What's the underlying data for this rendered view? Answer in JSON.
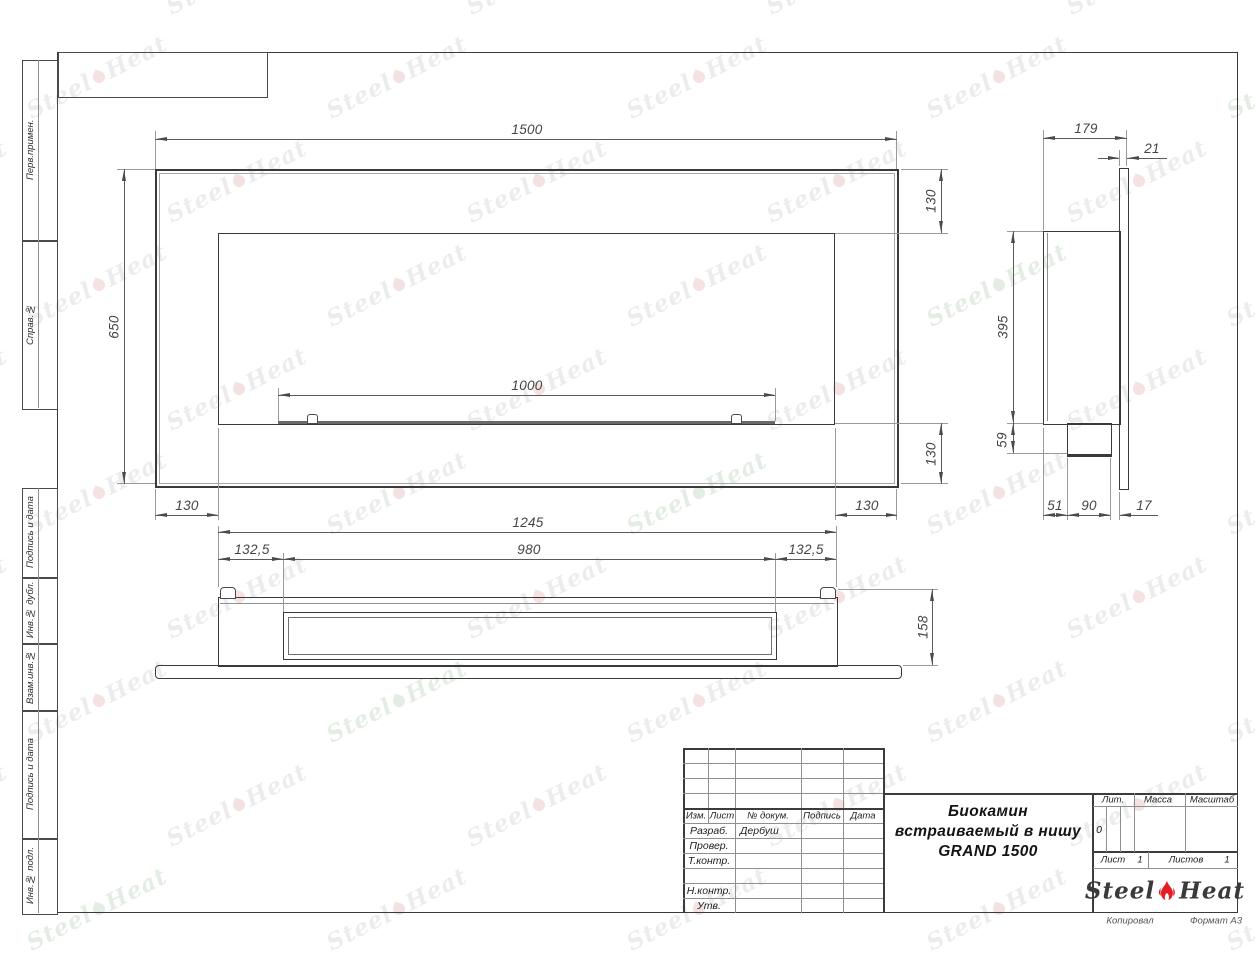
{
  "colors": {
    "line": "#3a3a3a",
    "dim_text": "#454545",
    "logo_red": "#e31e24",
    "watermark_gray": "#dedede",
    "watermark_pink": "#eccaca",
    "watermark_green": "#cfe0cf"
  },
  "watermark": {
    "steel": "Steel",
    "heat": "Heat"
  },
  "left_band": {
    "labels": [
      "Перв.примен.",
      "Справ.№",
      "Подпись и дата",
      "Инв.№ дубл.",
      "Взам.инв.№",
      "Подпись и дата",
      "Инв.№ подл."
    ]
  },
  "front_view": {
    "width": "1500",
    "height": "650",
    "burner": "1000",
    "offset_top": "130",
    "offset_bottom": "130",
    "offset_left": "130",
    "offset_right": "130"
  },
  "side_view": {
    "depth": "179",
    "panel": "21",
    "height": "395",
    "burner_height": "59",
    "back": "51",
    "burner_depth": "90",
    "gap": "17"
  },
  "bottom_view": {
    "width": "1245",
    "left": "132,5",
    "slot": "980",
    "right": "132,5",
    "height": "158"
  },
  "title_block": {
    "header": {
      "izm": "Изм.",
      "list": "Лист",
      "doc": "№ докум.",
      "sign": "Подпись",
      "date": "Дата"
    },
    "rows": [
      {
        "label": "Разраб.",
        "value": "Дербуш"
      },
      {
        "label": "Провер.",
        "value": ""
      },
      {
        "label": "Т.контр.",
        "value": ""
      },
      {
        "label": "Н.контр.",
        "value": ""
      },
      {
        "label": "Утв.",
        "value": ""
      }
    ],
    "title_line1": "Биокамин",
    "title_line2": "встраиваемый в нишу",
    "title_line3": "GRAND 1500",
    "lit_label": "Лит.",
    "lit_value": "0",
    "massa_label": "Масса",
    "masshtab_label": "Масштаб",
    "list_label": "Лист",
    "list_value": "1",
    "listov_label": "Листов",
    "listov_value": "1",
    "logo_steel": "Steel",
    "logo_heat": "Heat",
    "kopiroval": "Копировал",
    "format": "Формат А3"
  }
}
